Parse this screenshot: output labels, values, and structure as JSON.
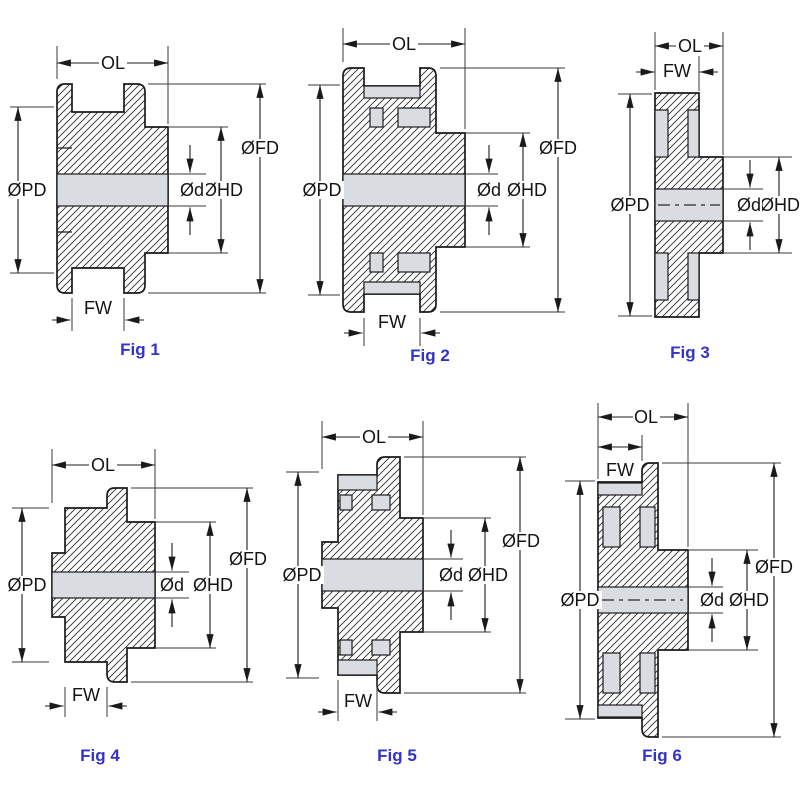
{
  "dim_labels": {
    "ol": "OL",
    "fw": "FW",
    "pd": "ØPD",
    "fd": "ØFD",
    "hd": "ØHD",
    "d": "Ød"
  },
  "figures": [
    {
      "caption": "Fig 1"
    },
    {
      "caption": "Fig 2"
    },
    {
      "caption": "Fig 3"
    },
    {
      "caption": "Fig 4"
    },
    {
      "caption": "Fig 5"
    },
    {
      "caption": "Fig 6"
    }
  ],
  "colors": {
    "caption_blue": "#3333cc",
    "outline_black": "#1a1a1a",
    "bore_gray": "#d9dde1",
    "background": "#ffffff"
  }
}
